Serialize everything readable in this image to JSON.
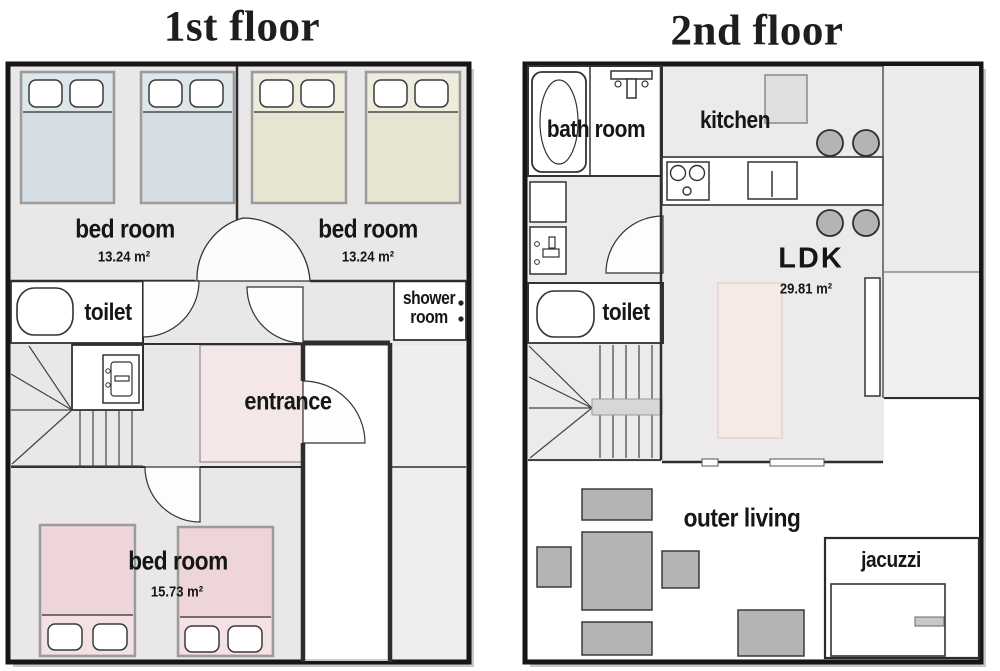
{
  "floor1": {
    "title": "1st floor",
    "bedroom_nw": {
      "label": "bed room",
      "area": "13.24 m²"
    },
    "bedroom_ne": {
      "label": "bed room",
      "area": "13.24 m²"
    },
    "toilet_label": "toilet",
    "shower": {
      "line1": "shower",
      "line2": "room"
    },
    "entrance_label": "entrance",
    "bedroom_s": {
      "label": "bed room",
      "area": "15.73 m²"
    }
  },
  "floor2": {
    "title": "2nd floor",
    "bathroom_label": "bath room",
    "kitchen_label": "kitchen",
    "ldk": {
      "label": "LDK",
      "area": "29.81 m²"
    },
    "toilet_label": "toilet",
    "outer_living_label": "outer living",
    "jacuzzi_label": "jacuzzi"
  },
  "colors": {
    "wall": "#161616",
    "floor_gray": "#e9e7e8",
    "floor2_gray": "#eceaeb",
    "bed_blue": "#d3dde3",
    "bed_beige": "#e7e5d1",
    "bed_pink": "#eed5d9",
    "entrance_pink": "#f5e7e7",
    "rug_pink": "#f6eae6",
    "furniture_gray": "#b5b3b4"
  },
  "fixtures": [
    "bed-icon",
    "pillow-icon",
    "toilet-bowl-icon",
    "washbasin-icon",
    "staircase-icon",
    "door-arc-icon",
    "bathtub-icon",
    "shower-head-icon",
    "stove-icon",
    "kitchen-sink-icon",
    "fridge-icon",
    "stool-icon",
    "rug-icon",
    "jacuzzi-tub-icon"
  ]
}
